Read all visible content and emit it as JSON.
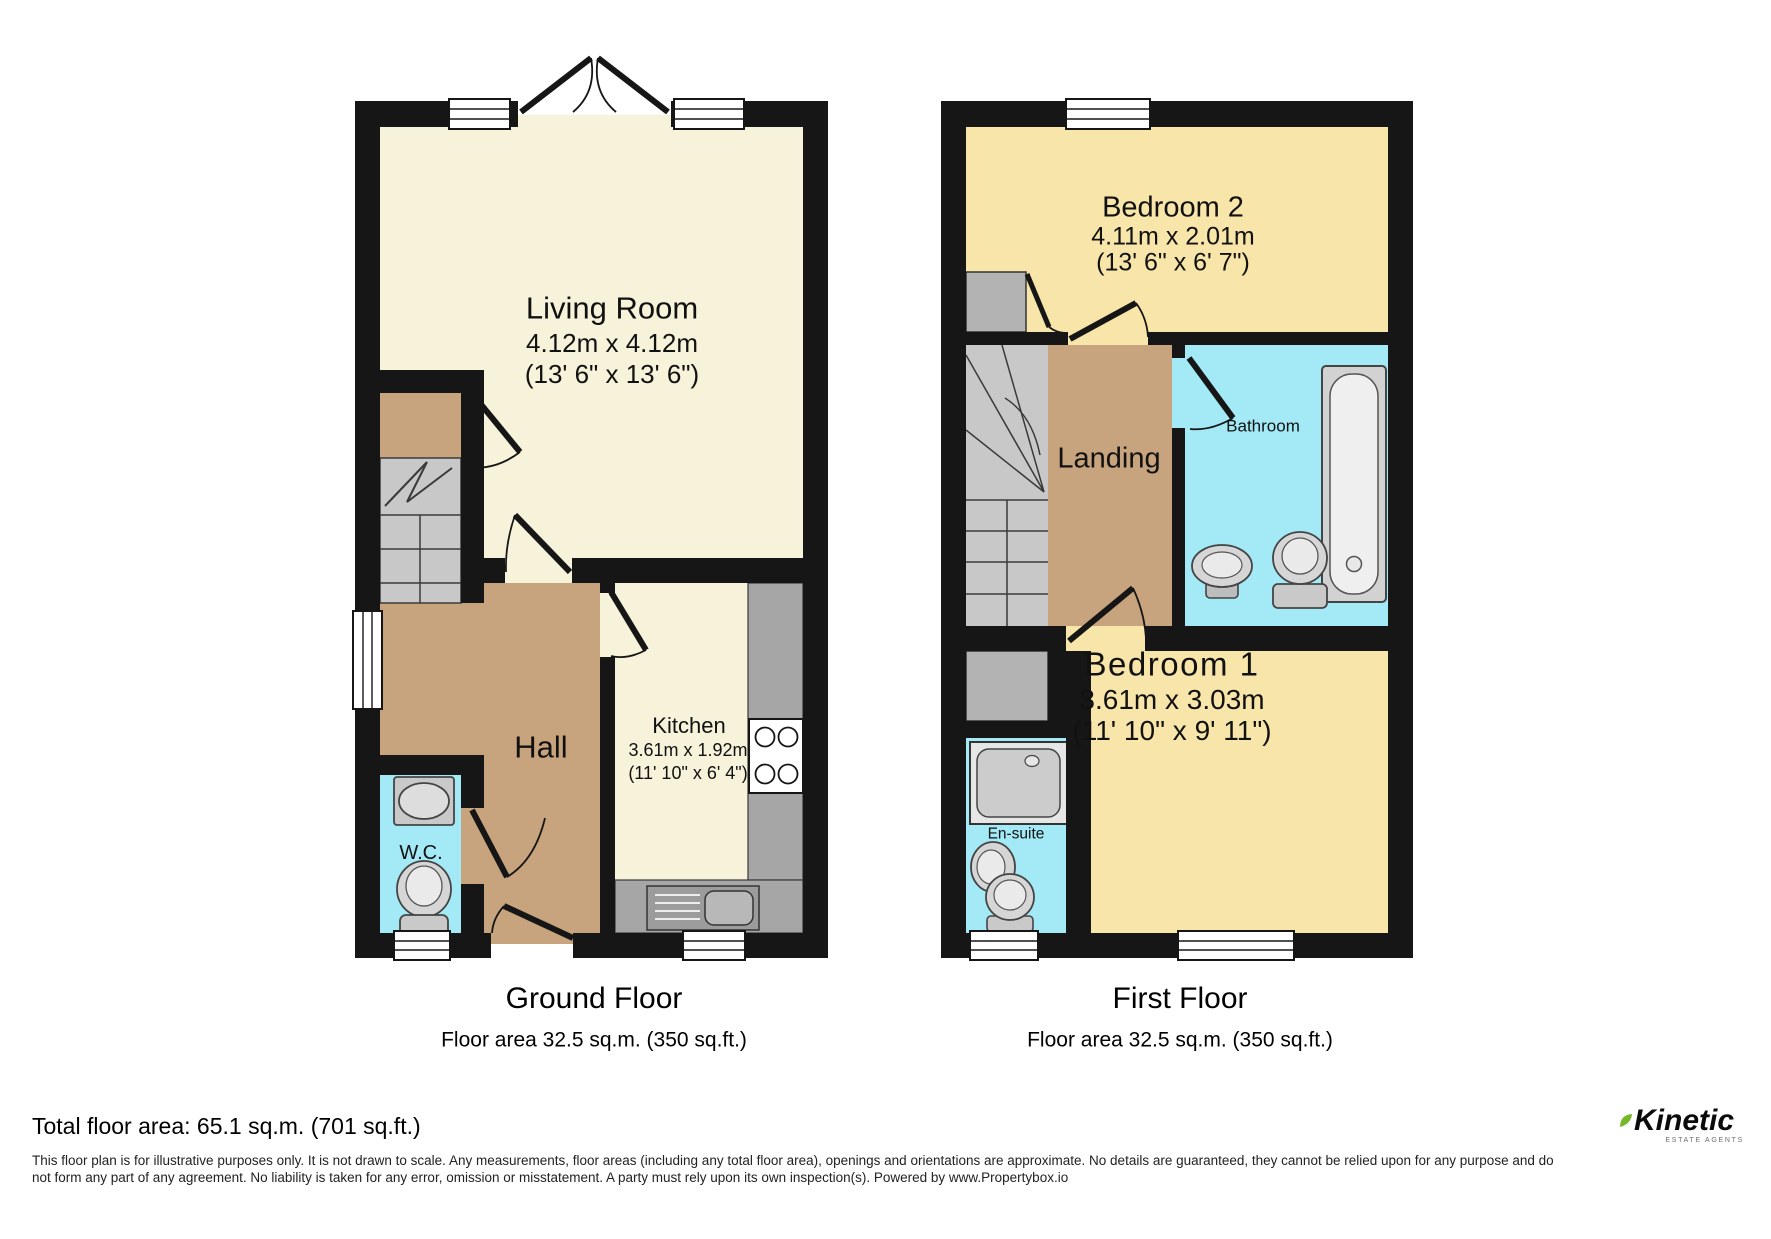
{
  "ground_floor": {
    "title": "Ground Floor",
    "floor_area": "Floor area 32.5 sq.m. (350 sq.ft.)",
    "living_room": {
      "name": "Living Room",
      "size_metric": "4.12m x 4.12m",
      "size_imperial": "(13' 6\" x 13' 6\")"
    },
    "hall": {
      "name": "Hall"
    },
    "kitchen": {
      "name": "Kitchen",
      "size_metric": "3.61m x 1.92m",
      "size_imperial": "(11' 10\" x 6' 4\")"
    },
    "wc": {
      "name": "W.C."
    }
  },
  "first_floor": {
    "title": "First Floor",
    "floor_area": "Floor area 32.5 sq.m. (350 sq.ft.)",
    "bedroom2": {
      "name": "Bedroom 2",
      "size_metric": "4.11m x 2.01m",
      "size_imperial": "(13' 6\" x 6' 7\")"
    },
    "landing": {
      "name": "Landing"
    },
    "bathroom": {
      "name": "Bathroom"
    },
    "bedroom1": {
      "name": "Bedroom 1",
      "size_metric": "3.61m x 3.03m",
      "size_imperial": "(11' 10\" x 9' 11\")"
    },
    "ensuite": {
      "name": "En-suite"
    }
  },
  "footer": {
    "total_area": "Total floor area: 65.1 sq.m. (701 sq.ft.)",
    "disclaimer": "This floor plan is for illustrative purposes only. It is not drawn to scale. Any measurements, floor areas (including any total floor area), openings and orientations are approximate. No details are guaranteed, they cannot be relied upon for any purpose and do not form any part of any agreement. No liability is taken for any error, omission or misstatement. A party must rely upon its own inspection(s). Powered by www.Propertybox.io",
    "brand": {
      "name": "Kinetic",
      "tagline": "ESTATE AGENTS"
    }
  },
  "colors": {
    "room_cream": "#F7F2DA",
    "room_yellow": "#F8E5A9",
    "hall_brown": "#C7A47D",
    "wet_room_cyan": "#A3E9F6",
    "stairs_gray": "#C8C8C8",
    "closet_gray": "#B3B3B3",
    "counter_gray": "#A6A6A6",
    "wall_black": "#161616",
    "logo_green": "#76B82A"
  }
}
